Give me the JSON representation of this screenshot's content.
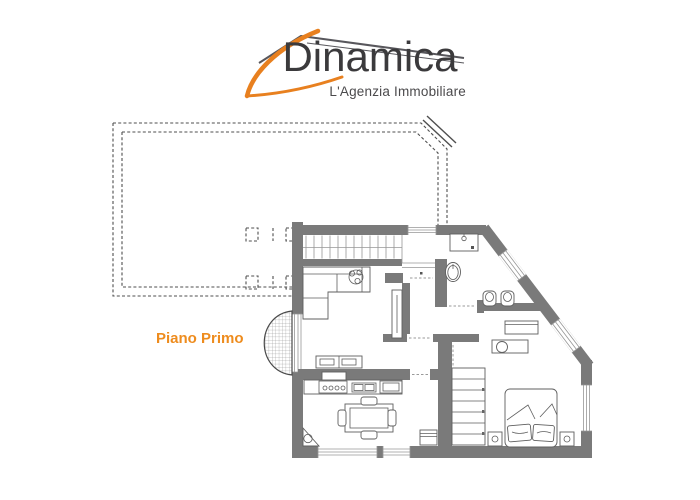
{
  "page": {
    "bg": "#ffffff"
  },
  "logo": {
    "title": "Dinamica",
    "tagline": "L'Agenzia Immobiliare",
    "accent_color": "#e8801f",
    "text_color": "#3b3a3c",
    "tagline_color": "#4b4a4c",
    "roof_color": "#58575c"
  },
  "caption": {
    "label": "Piano Primo",
    "color": "#ee8c1e"
  },
  "plan": {
    "wall_color": "#7a7a7a",
    "furniture_line_color": "#5f5f5f",
    "thin_line_color": "#979797",
    "terrace_line_color": "#4f4f4f"
  }
}
